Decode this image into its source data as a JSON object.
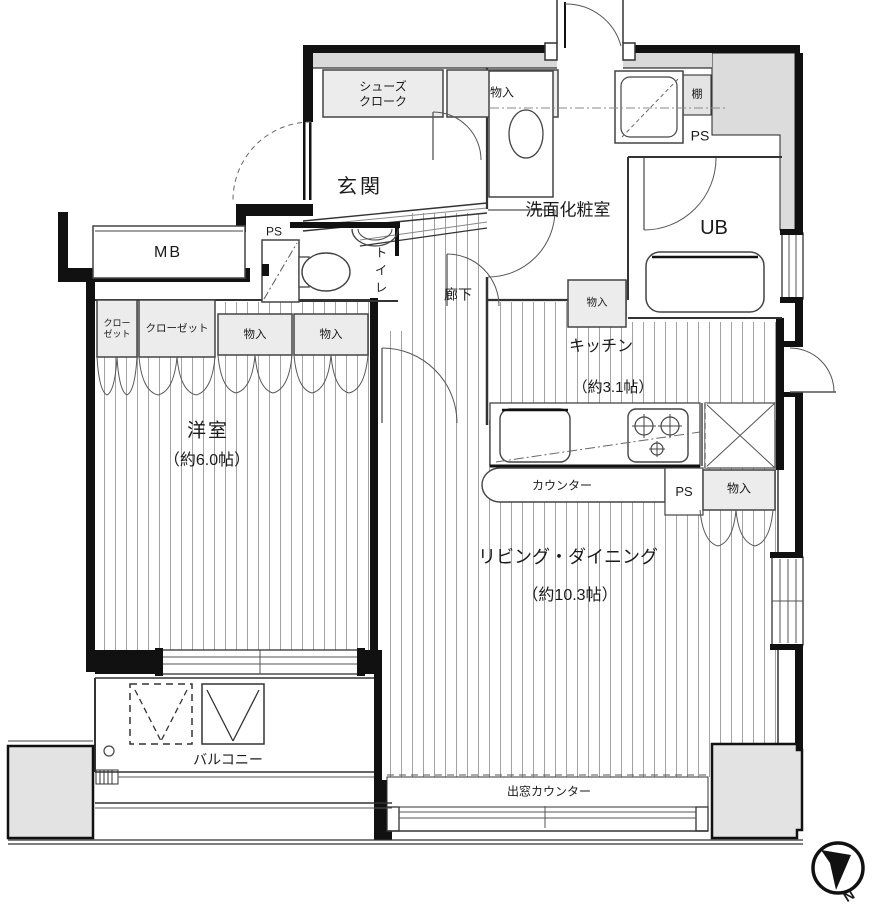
{
  "plan": {
    "title": "apartment-floor-plan",
    "labels": {
      "shoes_cloak": "シューズクローク",
      "storage": "物入",
      "entrance": "玄関",
      "washroom": "洗面化粧室",
      "shelf": "棚",
      "ps": "PS",
      "unit_bath": "UB",
      "meter_box": "MB",
      "toilet": "トイレ",
      "corridor": "廊下",
      "closet": "クローゼット",
      "kitchen": "キッチン",
      "kitchen_size": "（約3.1帖）",
      "counter": "カウンター",
      "living_dining": "リビング・ダイニング",
      "living_size": "（約10.3帖）",
      "western_room": "洋室",
      "western_size": "（約6.0帖）",
      "balcony": "バルコニー",
      "bay_window_counter": "出窓カウンター",
      "north": "N"
    },
    "colors": {
      "wall": "#111111",
      "thin_line": "#444444",
      "hatch": "#a3a3a3",
      "box_fill": "#ececec",
      "poche_fill": "#dcdcdc",
      "block_fill": "#e3e3e3"
    }
  }
}
